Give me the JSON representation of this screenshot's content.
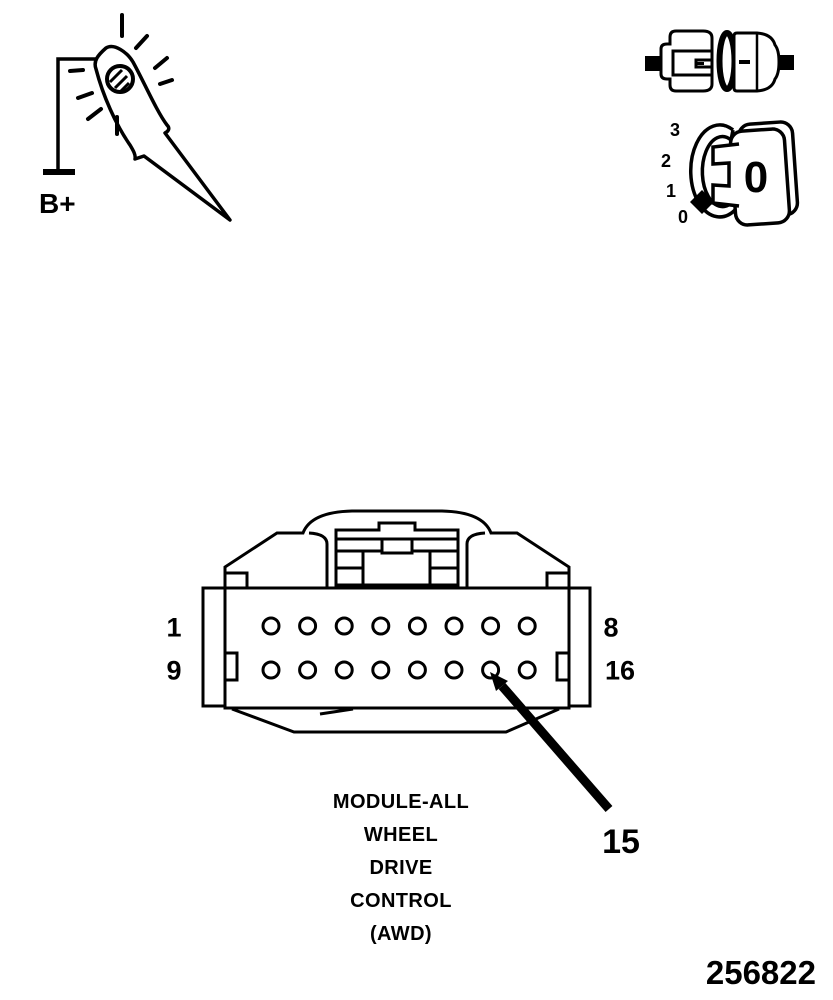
{
  "figure": {
    "number": "256822"
  },
  "test_light": {
    "battery_label": "B+"
  },
  "ignition_key": {
    "position_labels": [
      "3",
      "2",
      "1",
      "0"
    ],
    "key_face_label": "0"
  },
  "connector": {
    "rows": 2,
    "pins_per_row": 8,
    "row_labels": [
      {
        "start": "1",
        "end": "8"
      },
      {
        "start": "9",
        "end": "16"
      }
    ],
    "callout_pin": "15",
    "caption_lines": [
      "MODULE-ALL",
      "WHEEL",
      "DRIVE",
      "CONTROL",
      "(AWD)"
    ]
  },
  "colors": {
    "line": "#000000",
    "background": "#ffffff"
  }
}
